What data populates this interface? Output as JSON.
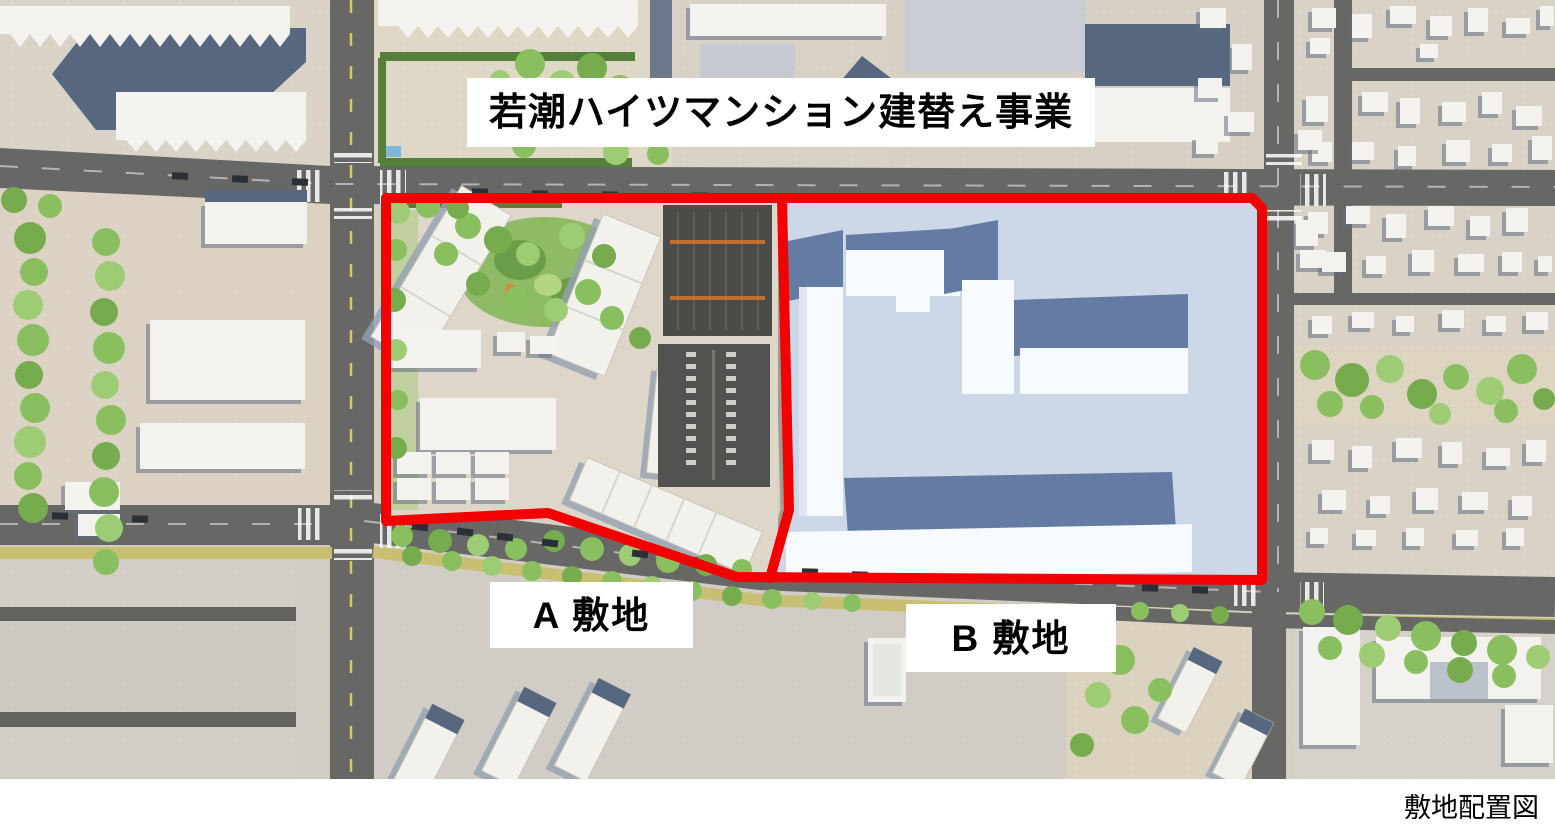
{
  "annotations": {
    "title": "若潮ハイツマンション建替え事業",
    "site_a_label": "A 敷地",
    "site_b_label": "B 敷地"
  },
  "footer": {
    "caption": "敷地配置図"
  },
  "colors": {
    "accent_red": "#f20000",
    "road": "#676765",
    "road_median": "#c9bf72",
    "ground": "#d6cfc3",
    "building_white": "#f4f2ee",
    "roof_slate": "#56677f",
    "site_b_fill": "#ccd7e8",
    "site_b_roof": "#647ba3",
    "site_b_face": "#f7fafd",
    "tree_green": "#8abf60",
    "parking_dark": "#4b4b47",
    "label_bg": "#ffffff",
    "text": "#000000"
  }
}
